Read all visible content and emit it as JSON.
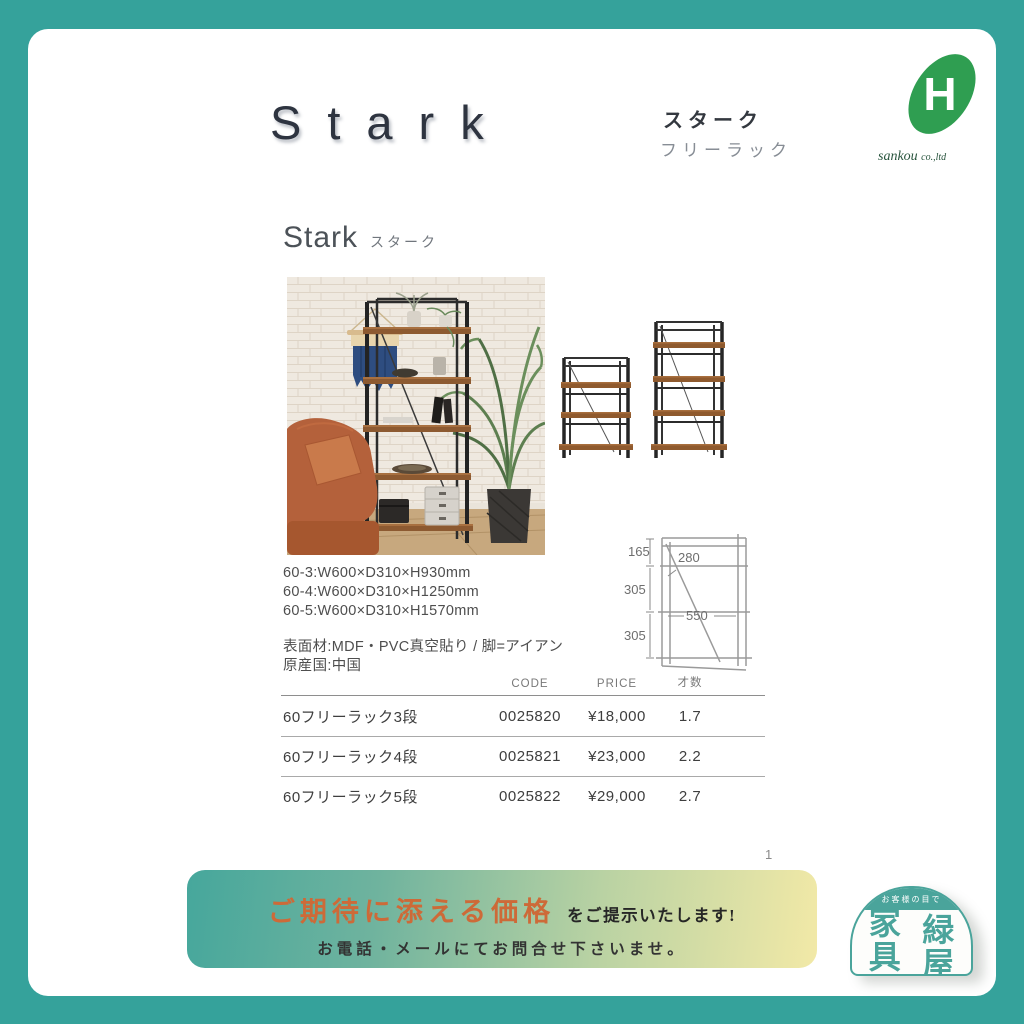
{
  "frame": {
    "teal": "#35a29b"
  },
  "header": {
    "title": "Stark",
    "title_jp": "スターク",
    "subtitle_jp": "フリーラック",
    "logo": {
      "monogram": "H",
      "company": "sankou",
      "suffix": "co.,ltd",
      "green": "#2f9e51"
    }
  },
  "product": {
    "section_title_en": "Stark",
    "section_title_jp": "スターク",
    "dimensions": [
      "60-3:W600×D310×H930mm",
      "60-4:W600×D310×H1250mm",
      "60-5:W600×D310×H1570mm"
    ],
    "material": "表面材:MDF・PVC真空貼り / 脚=アイアン",
    "origin": "原産国:中国",
    "diagram_labels": {
      "top_gap": "165",
      "mid_gap": "305",
      "bottom_gap": "305",
      "inner_width": "280",
      "shelf_width": "550"
    }
  },
  "table": {
    "headers": {
      "code": "CODE",
      "price": "PRICE",
      "saisu": "才数"
    },
    "rows": [
      {
        "name": "60フリーラック3段",
        "code": "0025820",
        "price": "¥18,000",
        "saisu": "1.7"
      },
      {
        "name": "60フリーラック4段",
        "code": "0025821",
        "price": "¥23,000",
        "saisu": "2.2"
      },
      {
        "name": "60フリーラック5段",
        "code": "0025822",
        "price": "¥29,000",
        "saisu": "2.7"
      }
    ]
  },
  "page_number": "1",
  "banner": {
    "highlight": "ご期待に添える価格",
    "suffix": "をご提示いたします!",
    "line2": "お電話・メールにてお問合せ下さいませ。",
    "highlight_color": "#cd6a38"
  },
  "stamp": {
    "arc_text": "お客様の目で",
    "chars": [
      "家",
      "緑",
      "具",
      "屋"
    ],
    "color": "#4aa49b"
  }
}
